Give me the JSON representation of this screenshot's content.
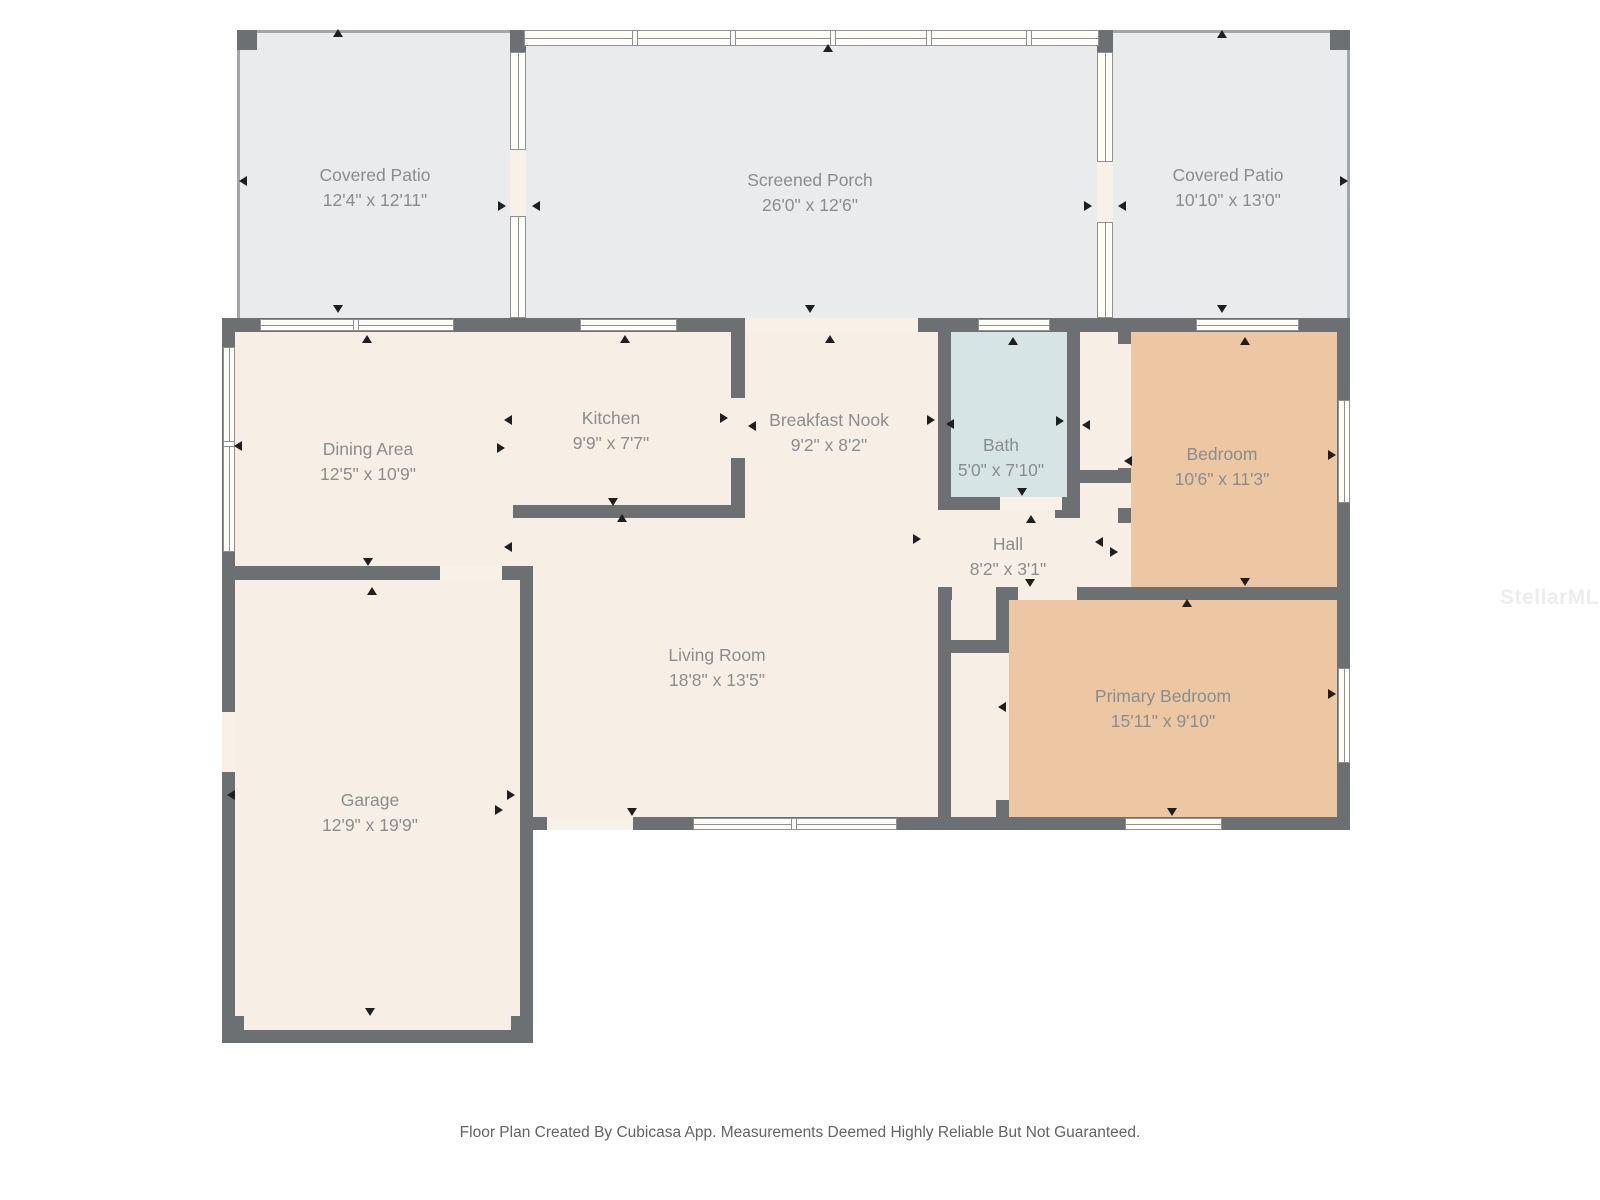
{
  "page": {
    "width": 1600,
    "height": 1200,
    "background": "#ffffff"
  },
  "footer": {
    "text": "Floor Plan Created By Cubicasa App. Measurements Deemed Highly Reliable But Not Guaranteed."
  },
  "watermark": {
    "text": "StellarMLS"
  },
  "palette": {
    "wall": "#6d7072",
    "patio_fill": "#e9ebec",
    "interior_fill": "#f7efe6",
    "bedroom_fill": "#edc7a3",
    "bath_fill": "#d7e4e6",
    "window_fill": "#fffdf8",
    "window_line": "#8f9294",
    "opening_fill": "#f7f1e8",
    "patio_line": "#a4a7a9",
    "label_color": "#8a8d8d",
    "arrow_color": "#1f1f1f",
    "footer_color": "#636363",
    "watermark_color": "#ededed"
  },
  "floorplan": {
    "rooms": [
      {
        "name": "Covered Patio",
        "dims": "12'4\" x 12'11\"",
        "label_x": 375,
        "label_y": 176
      },
      {
        "name": "Screened Porch",
        "dims": "26'0\" x 12'6\"",
        "label_x": 810,
        "label_y": 181
      },
      {
        "name": "Covered Patio",
        "dims": "10'10\" x 13'0\"",
        "label_x": 1228,
        "label_y": 176
      },
      {
        "name": "Dining Area",
        "dims": "12'5\" x 10'9\"",
        "label_x": 368,
        "label_y": 450
      },
      {
        "name": "Kitchen",
        "dims": "9'9\" x 7'7\"",
        "label_x": 611,
        "label_y": 419
      },
      {
        "name": "Breakfast Nook",
        "dims": "9'2\" x 8'2\"",
        "label_x": 829,
        "label_y": 421
      },
      {
        "name": "Bath",
        "dims": "5'0\" x 7'10\"",
        "label_x": 1001,
        "label_y": 446
      },
      {
        "name": "Bedroom",
        "dims": "10'6\" x 11'3\"",
        "label_x": 1222,
        "label_y": 455
      },
      {
        "name": "Hall",
        "dims": "8'2\" x 3'1\"",
        "label_x": 1008,
        "label_y": 545
      },
      {
        "name": "Living Room",
        "dims": "18'8\" x 13'5\"",
        "label_x": 717,
        "label_y": 656
      },
      {
        "name": "Primary Bedroom",
        "dims": "15'11\" x 9'10\"",
        "label_x": 1163,
        "label_y": 697
      },
      {
        "name": "Garage",
        "dims": "12'9\" x 19'9\"",
        "label_x": 370,
        "label_y": 801
      }
    ],
    "fills": [
      {
        "name": "covered-patio-left-floor",
        "rect": [
          237,
          33,
          273,
          285
        ],
        "fill": "patio_fill"
      },
      {
        "name": "screened-porch-floor",
        "rect": [
          526,
          45,
          571,
          273
        ],
        "fill": "patio_fill"
      },
      {
        "name": "covered-patio-right-floor",
        "rect": [
          1113,
          33,
          234,
          285
        ],
        "fill": "patio_fill"
      },
      {
        "name": "main-interior-floor",
        "rect": [
          235,
          332,
          1102,
          485
        ],
        "fill": "interior_fill"
      },
      {
        "name": "garage-floor",
        "rect": [
          235,
          580,
          285,
          450
        ],
        "fill": "interior_fill"
      },
      {
        "name": "bedroom-floor",
        "rect": [
          1131,
          332,
          206,
          255
        ],
        "fill": "bedroom_fill"
      },
      {
        "name": "primary-bedroom-floor",
        "rect": [
          1009,
          600,
          328,
          217
        ],
        "fill": "bedroom_fill"
      },
      {
        "name": "bath-floor",
        "rect": [
          951,
          332,
          116,
          165
        ],
        "fill": "bath_fill"
      }
    ],
    "patio_lines": [
      {
        "name": "patio-left-top-edge",
        "rect": [
          237,
          30,
          275,
          3
        ]
      },
      {
        "name": "patio-left-side-edge",
        "rect": [
          237,
          30,
          3,
          288
        ]
      },
      {
        "name": "patio-right-top-edge",
        "rect": [
          1111,
          30,
          239,
          3
        ]
      },
      {
        "name": "patio-right-side-edge",
        "rect": [
          1347,
          30,
          3,
          288
        ]
      }
    ],
    "walls": [
      {
        "name": "wall-top-main",
        "rect": [
          222,
          318,
          1128,
          14
        ]
      },
      {
        "name": "wall-left-main",
        "rect": [
          222,
          318,
          13,
          262
        ]
      },
      {
        "name": "wall-dining-garage",
        "rect": [
          222,
          566,
          311,
          14
        ]
      },
      {
        "name": "wall-garage-left",
        "rect": [
          222,
          580,
          13,
          463
        ]
      },
      {
        "name": "wall-garage-bottom",
        "rect": [
          222,
          1030,
          311,
          13
        ]
      },
      {
        "name": "wall-garage-right",
        "rect": [
          520,
          580,
          13,
          463
        ]
      },
      {
        "name": "wall-living-bottom",
        "rect": [
          533,
          817,
          817,
          13
        ]
      },
      {
        "name": "wall-right-main",
        "rect": [
          1337,
          318,
          13,
          512
        ]
      },
      {
        "name": "wall-kitchen-bottom",
        "rect": [
          513,
          505,
          232,
          13
        ]
      },
      {
        "name": "wall-kitchen-right-upper",
        "rect": [
          731,
          332,
          14,
          66
        ]
      },
      {
        "name": "wall-kitchen-right-lower",
        "rect": [
          731,
          458,
          14,
          60
        ]
      },
      {
        "name": "wall-bath-left",
        "rect": [
          938,
          332,
          13,
          178
        ]
      },
      {
        "name": "wall-bath-right",
        "rect": [
          1067,
          332,
          13,
          183
        ]
      },
      {
        "name": "wall-bath-bottom",
        "rect": [
          938,
          497,
          142,
          13
        ]
      },
      {
        "name": "wall-nook-stub",
        "rect": [
          1080,
          470,
          50,
          13
        ]
      },
      {
        "name": "wall-bath-corner-piece",
        "rect": [
          1055,
          505,
          25,
          13
        ]
      },
      {
        "name": "wall-bedroom-left-top",
        "rect": [
          1118,
          332,
          13,
          12
        ]
      },
      {
        "name": "wall-bedroom-left-mid",
        "rect": [
          1118,
          468,
          13,
          15
        ]
      },
      {
        "name": "wall-bedroom-left-block",
        "rect": [
          1118,
          508,
          13,
          15
        ]
      },
      {
        "name": "wall-hall-bottom-a",
        "rect": [
          938,
          587,
          14,
          13
        ]
      },
      {
        "name": "wall-hall-bottom-b",
        "rect": [
          996,
          587,
          22,
          13
        ]
      },
      {
        "name": "wall-bedroom-bottom",
        "rect": [
          1077,
          587,
          273,
          13
        ]
      },
      {
        "name": "wall-closet-left",
        "rect": [
          938,
          587,
          13,
          243
        ]
      },
      {
        "name": "wall-closet-divider",
        "rect": [
          947,
          640,
          61,
          13
        ]
      },
      {
        "name": "wall-primary-left-upper",
        "rect": [
          996,
          587,
          13,
          66
        ]
      },
      {
        "name": "wall-primary-left-stub",
        "rect": [
          996,
          800,
          13,
          17
        ]
      }
    ],
    "blocks": [
      {
        "name": "corner-block-patio-left",
        "rect": [
          237,
          30,
          20,
          20
        ]
      },
      {
        "name": "corner-block-patio-right",
        "rect": [
          1330,
          30,
          20,
          20
        ]
      },
      {
        "name": "corner-block-garage-left",
        "rect": [
          222,
          1016,
          22,
          27
        ]
      },
      {
        "name": "corner-block-garage-right",
        "rect": [
          511,
          1016,
          22,
          27
        ]
      },
      {
        "name": "corner-block-divider-left",
        "rect": [
          510,
          30,
          16,
          22
        ]
      },
      {
        "name": "corner-block-divider-right",
        "rect": [
          1097,
          30,
          16,
          22
        ]
      }
    ],
    "openings": [
      {
        "name": "opening-porch-to-nook",
        "rect": [
          745,
          318,
          173,
          14
        ]
      },
      {
        "name": "opening-dining-garage",
        "rect": [
          440,
          566,
          62,
          14
        ]
      },
      {
        "name": "opening-garage-side",
        "rect": [
          222,
          712,
          13,
          60
        ]
      },
      {
        "name": "opening-living-door",
        "rect": [
          547,
          817,
          86,
          13
        ]
      },
      {
        "name": "opening-bath-door",
        "rect": [
          1000,
          497,
          62,
          13
        ]
      },
      {
        "name": "opening-patio-divider-l",
        "rect": [
          510,
          150,
          16,
          66
        ]
      },
      {
        "name": "opening-patio-divider-r",
        "rect": [
          1097,
          162,
          16,
          60
        ]
      }
    ],
    "porch_band": {
      "name": "porch-screen-band",
      "rect": [
        524,
        30,
        575,
        16
      ],
      "mullions": [
        110,
        208,
        308,
        404,
        504
      ]
    },
    "windows": [
      {
        "name": "window-dining-top",
        "rect": [
          260,
          319,
          194,
          12
        ],
        "mullions": [
          95
        ]
      },
      {
        "name": "window-kitchen-top",
        "rect": [
          580,
          319,
          97,
          12
        ],
        "mullions": []
      },
      {
        "name": "window-bath-top",
        "rect": [
          978,
          319,
          72,
          12
        ],
        "mullions": []
      },
      {
        "name": "window-bedroom-top",
        "rect": [
          1196,
          319,
          103,
          12
        ],
        "mullions": []
      },
      {
        "name": "window-dining-left",
        "rect": [
          223,
          347,
          12,
          205
        ],
        "mullions": [
          96
        ]
      },
      {
        "name": "window-living-bottom",
        "rect": [
          693,
          818,
          204,
          12
        ],
        "mullions": [
          100
        ]
      },
      {
        "name": "window-primary-bottom",
        "rect": [
          1125,
          818,
          97,
          12
        ],
        "mullions": []
      },
      {
        "name": "window-bedroom-right",
        "rect": [
          1338,
          400,
          12,
          103
        ],
        "mullions": []
      },
      {
        "name": "window-primary-right",
        "rect": [
          1338,
          668,
          12,
          95
        ],
        "mullions": []
      },
      {
        "name": "window-divider-left-a",
        "rect": [
          510,
          52,
          16,
          98
        ],
        "mullions": []
      },
      {
        "name": "window-divider-left-b",
        "rect": [
          510,
          216,
          16,
          102
        ],
        "mullions": []
      },
      {
        "name": "window-divider-right-a",
        "rect": [
          1097,
          52,
          16,
          110
        ],
        "mullions": []
      },
      {
        "name": "window-divider-right-b",
        "rect": [
          1097,
          222,
          16,
          96
        ],
        "mullions": []
      }
    ],
    "arrows": [
      [
        338,
        33,
        "up"
      ],
      [
        243,
        181,
        "left"
      ],
      [
        338,
        309,
        "down"
      ],
      [
        828,
        48,
        "up"
      ],
      [
        810,
        309,
        "down"
      ],
      [
        830,
        339,
        "up"
      ],
      [
        502,
        206,
        "right"
      ],
      [
        536,
        206,
        "left"
      ],
      [
        1088,
        206,
        "right"
      ],
      [
        1122,
        206,
        "left"
      ],
      [
        1222,
        34,
        "up"
      ],
      [
        1344,
        181,
        "right"
      ],
      [
        1222,
        309,
        "down"
      ],
      [
        367,
        339,
        "up"
      ],
      [
        625,
        339,
        "up"
      ],
      [
        1013,
        341,
        "up"
      ],
      [
        1245,
        341,
        "up"
      ],
      [
        238,
        446,
        "left"
      ],
      [
        508,
        420,
        "left"
      ],
      [
        501,
        448,
        "right"
      ],
      [
        508,
        547,
        "left"
      ],
      [
        724,
        418,
        "right"
      ],
      [
        752,
        426,
        "left"
      ],
      [
        613,
        502,
        "down"
      ],
      [
        622,
        518,
        "up"
      ],
      [
        931,
        420,
        "right"
      ],
      [
        950,
        424,
        "left"
      ],
      [
        1060,
        421,
        "right"
      ],
      [
        1086,
        425,
        "left"
      ],
      [
        1022,
        492,
        "down"
      ],
      [
        1031,
        519,
        "up"
      ],
      [
        917,
        539,
        "right"
      ],
      [
        1099,
        542,
        "left"
      ],
      [
        1030,
        583,
        "down"
      ],
      [
        1128,
        461,
        "left"
      ],
      [
        1114,
        552,
        "right"
      ],
      [
        1245,
        582,
        "down"
      ],
      [
        1187,
        603,
        "up"
      ],
      [
        1002,
        707,
        "left"
      ],
      [
        632,
        812,
        "down"
      ],
      [
        499,
        810,
        "right"
      ],
      [
        1172,
        812,
        "down"
      ],
      [
        1332,
        455,
        "right"
      ],
      [
        1332,
        694,
        "right"
      ],
      [
        368,
        562,
        "down"
      ],
      [
        372,
        591,
        "up"
      ],
      [
        231,
        795,
        "left"
      ],
      [
        511,
        795,
        "right"
      ],
      [
        370,
        1012,
        "down"
      ]
    ]
  }
}
